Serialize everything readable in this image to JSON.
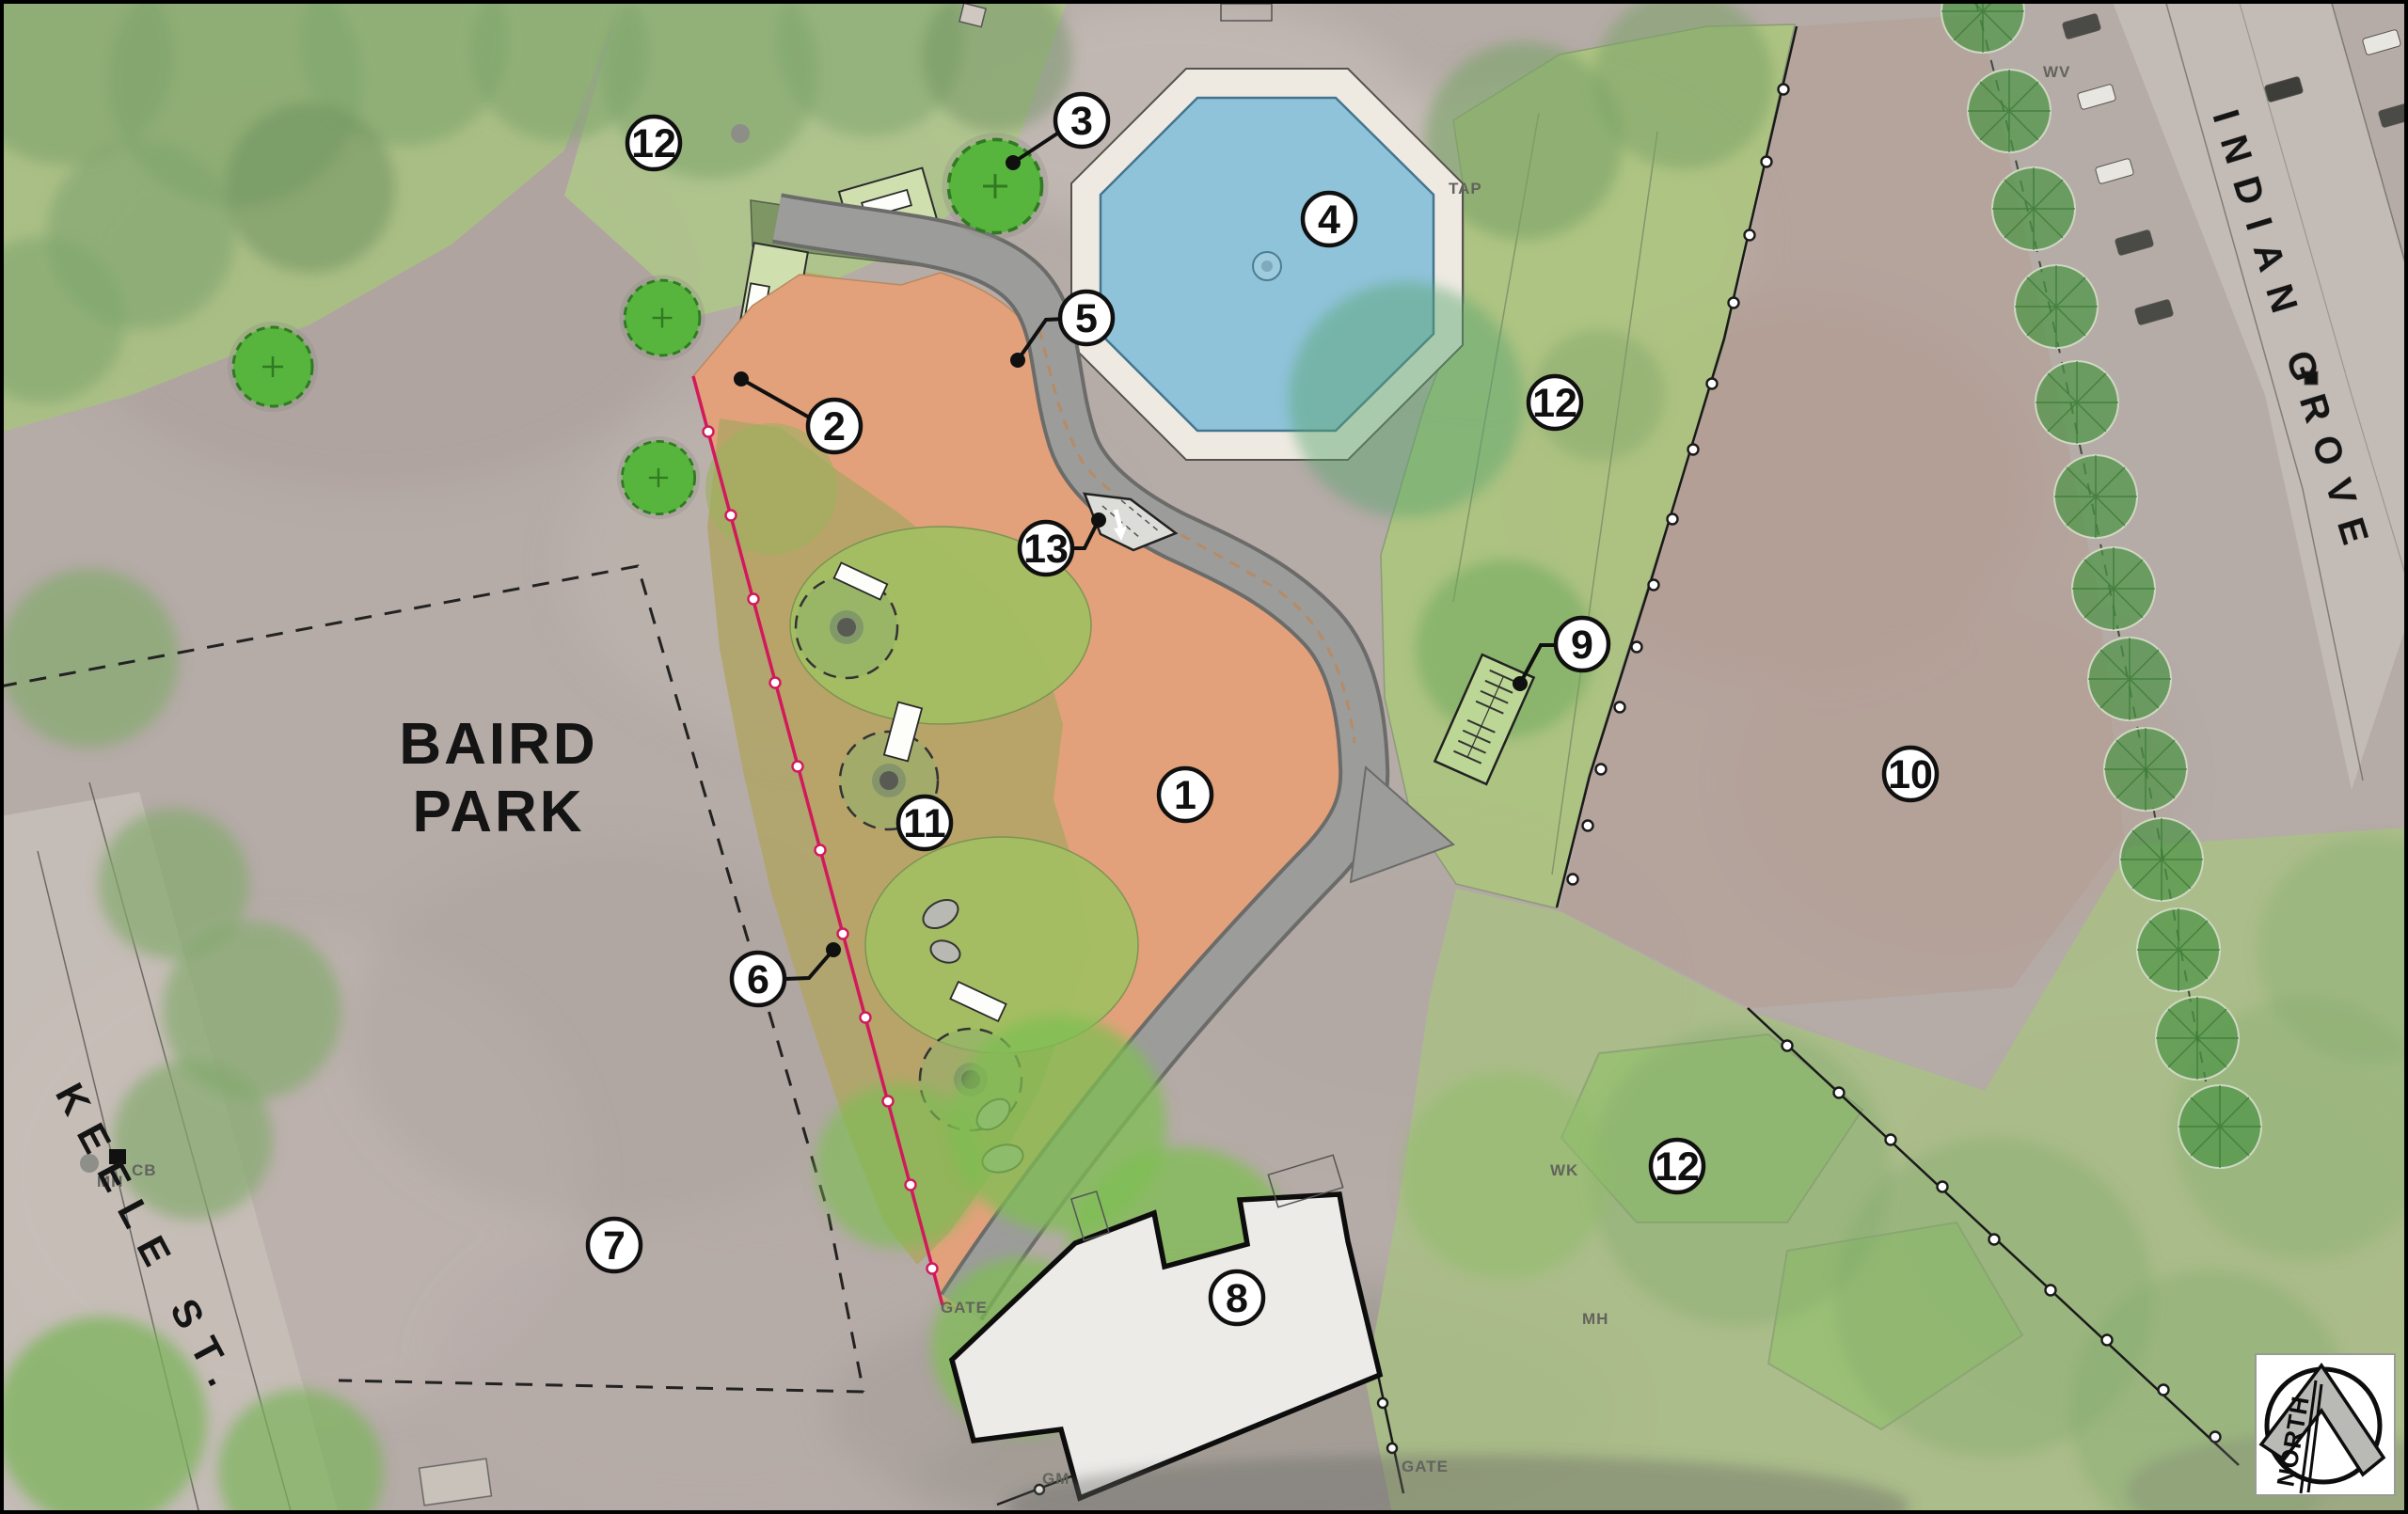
{
  "title": "Baird Park site plan",
  "park_label": {
    "line1": "BAIRD",
    "line2": "PARK"
  },
  "streets": {
    "west": "KEELE ST.",
    "east": "INDIAN GROVE"
  },
  "north_arrow": {
    "label": "NORTH"
  },
  "callouts": [
    {
      "label": "1"
    },
    {
      "label": "2"
    },
    {
      "label": "3"
    },
    {
      "label": "4"
    },
    {
      "label": "5"
    },
    {
      "label": "6"
    },
    {
      "label": "7"
    },
    {
      "label": "8"
    },
    {
      "label": "9"
    },
    {
      "label": "10"
    },
    {
      "label": "11"
    },
    {
      "label": "12"
    },
    {
      "label": "13"
    },
    {
      "label": "12"
    },
    {
      "label": "12"
    }
  ],
  "utility_labels": {
    "wv": "WV",
    "tap": "TAP",
    "mh_keele": "MH",
    "cb_keele": "CB",
    "wk": "WK",
    "mh_lawn": "MH",
    "gm": "GM",
    "gate_east": "GATE",
    "gate_south": "GATE"
  },
  "colors": {
    "wading_pool": "#8fc3da",
    "pool_deck": "#eeeae2",
    "playground_surface": "#e2a17b",
    "tree_canopy_olive": "#b0a465",
    "asphalt_path": "#9c9c9a",
    "lawn_green": "#abc382",
    "new_tree_green": "#55b43c",
    "new_fence_pink": "#d1195c",
    "existing_fence_black": "#1a1a1a",
    "building_fill": "#ecebe8"
  }
}
